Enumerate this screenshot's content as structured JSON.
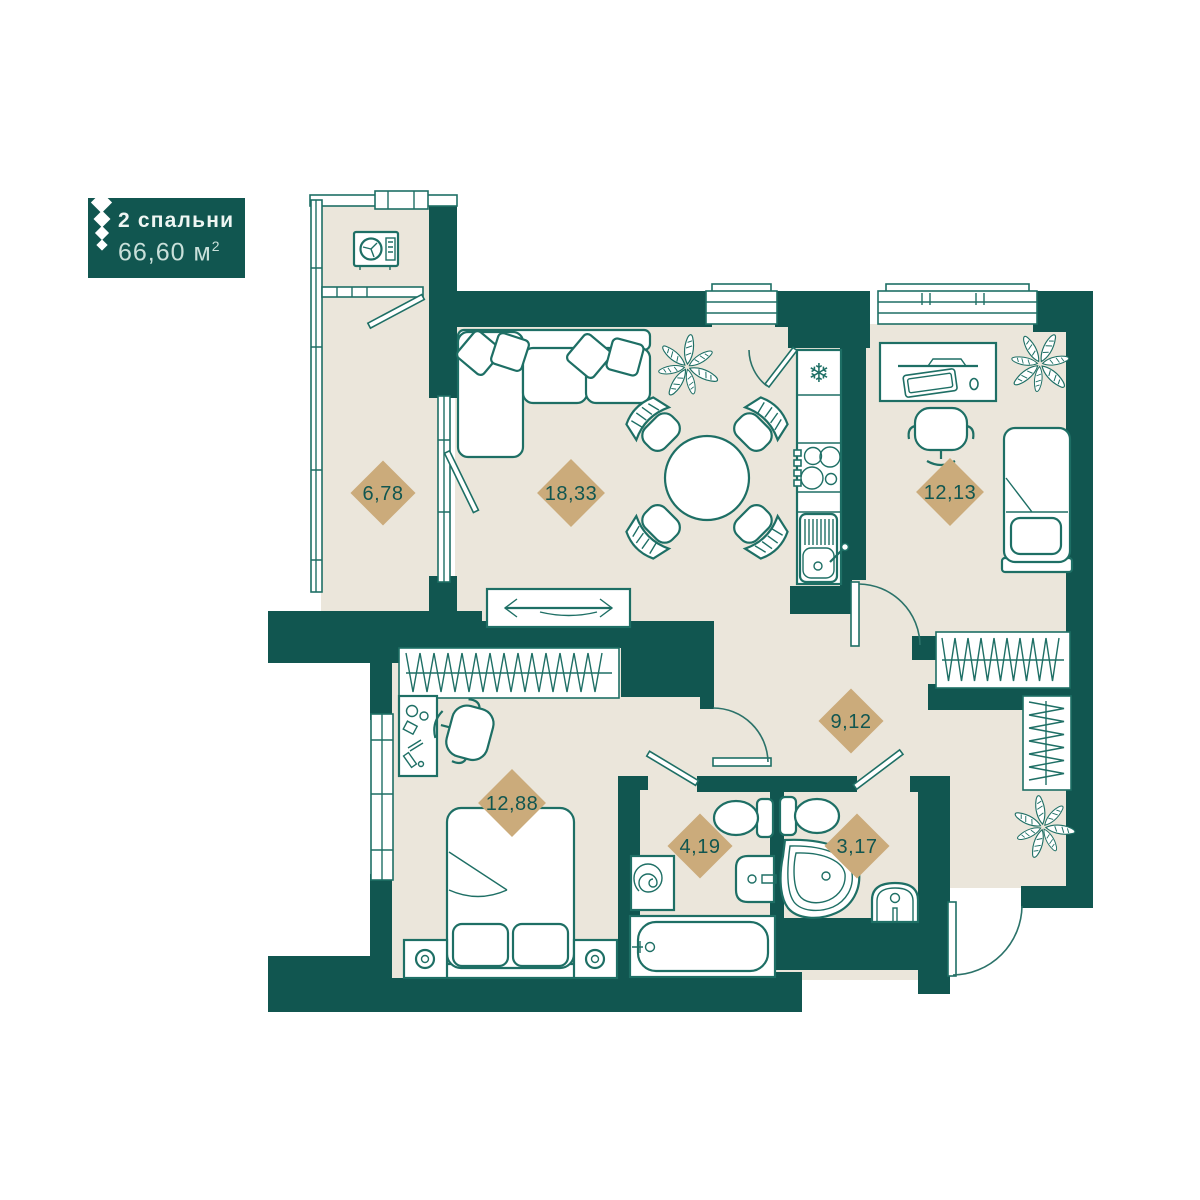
{
  "badge": {
    "title": "2 спальни",
    "area_value": "66,60",
    "area_unit": "м",
    "area_sup": "2"
  },
  "rooms": {
    "balcony": {
      "area": "6,78"
    },
    "living_kitchen": {
      "area": "18,33"
    },
    "bedroom_right": {
      "area": "12,13"
    },
    "hallway": {
      "area": "9,12"
    },
    "bedroom_left": {
      "area": "12,88"
    },
    "bathroom": {
      "area": "4,19"
    },
    "wc": {
      "area": "3,17"
    }
  },
  "icons": {
    "snowflake": "❄"
  },
  "colors": {
    "wall": "#115650",
    "floor": "#ebe6db",
    "furniture_line": "#1e6f65",
    "label_diamond": "#cbab7b",
    "label_text": "#115650",
    "badge_title_text": "#eef6f3",
    "badge_area_text": "#c9e0da",
    "background": "#ffffff"
  }
}
